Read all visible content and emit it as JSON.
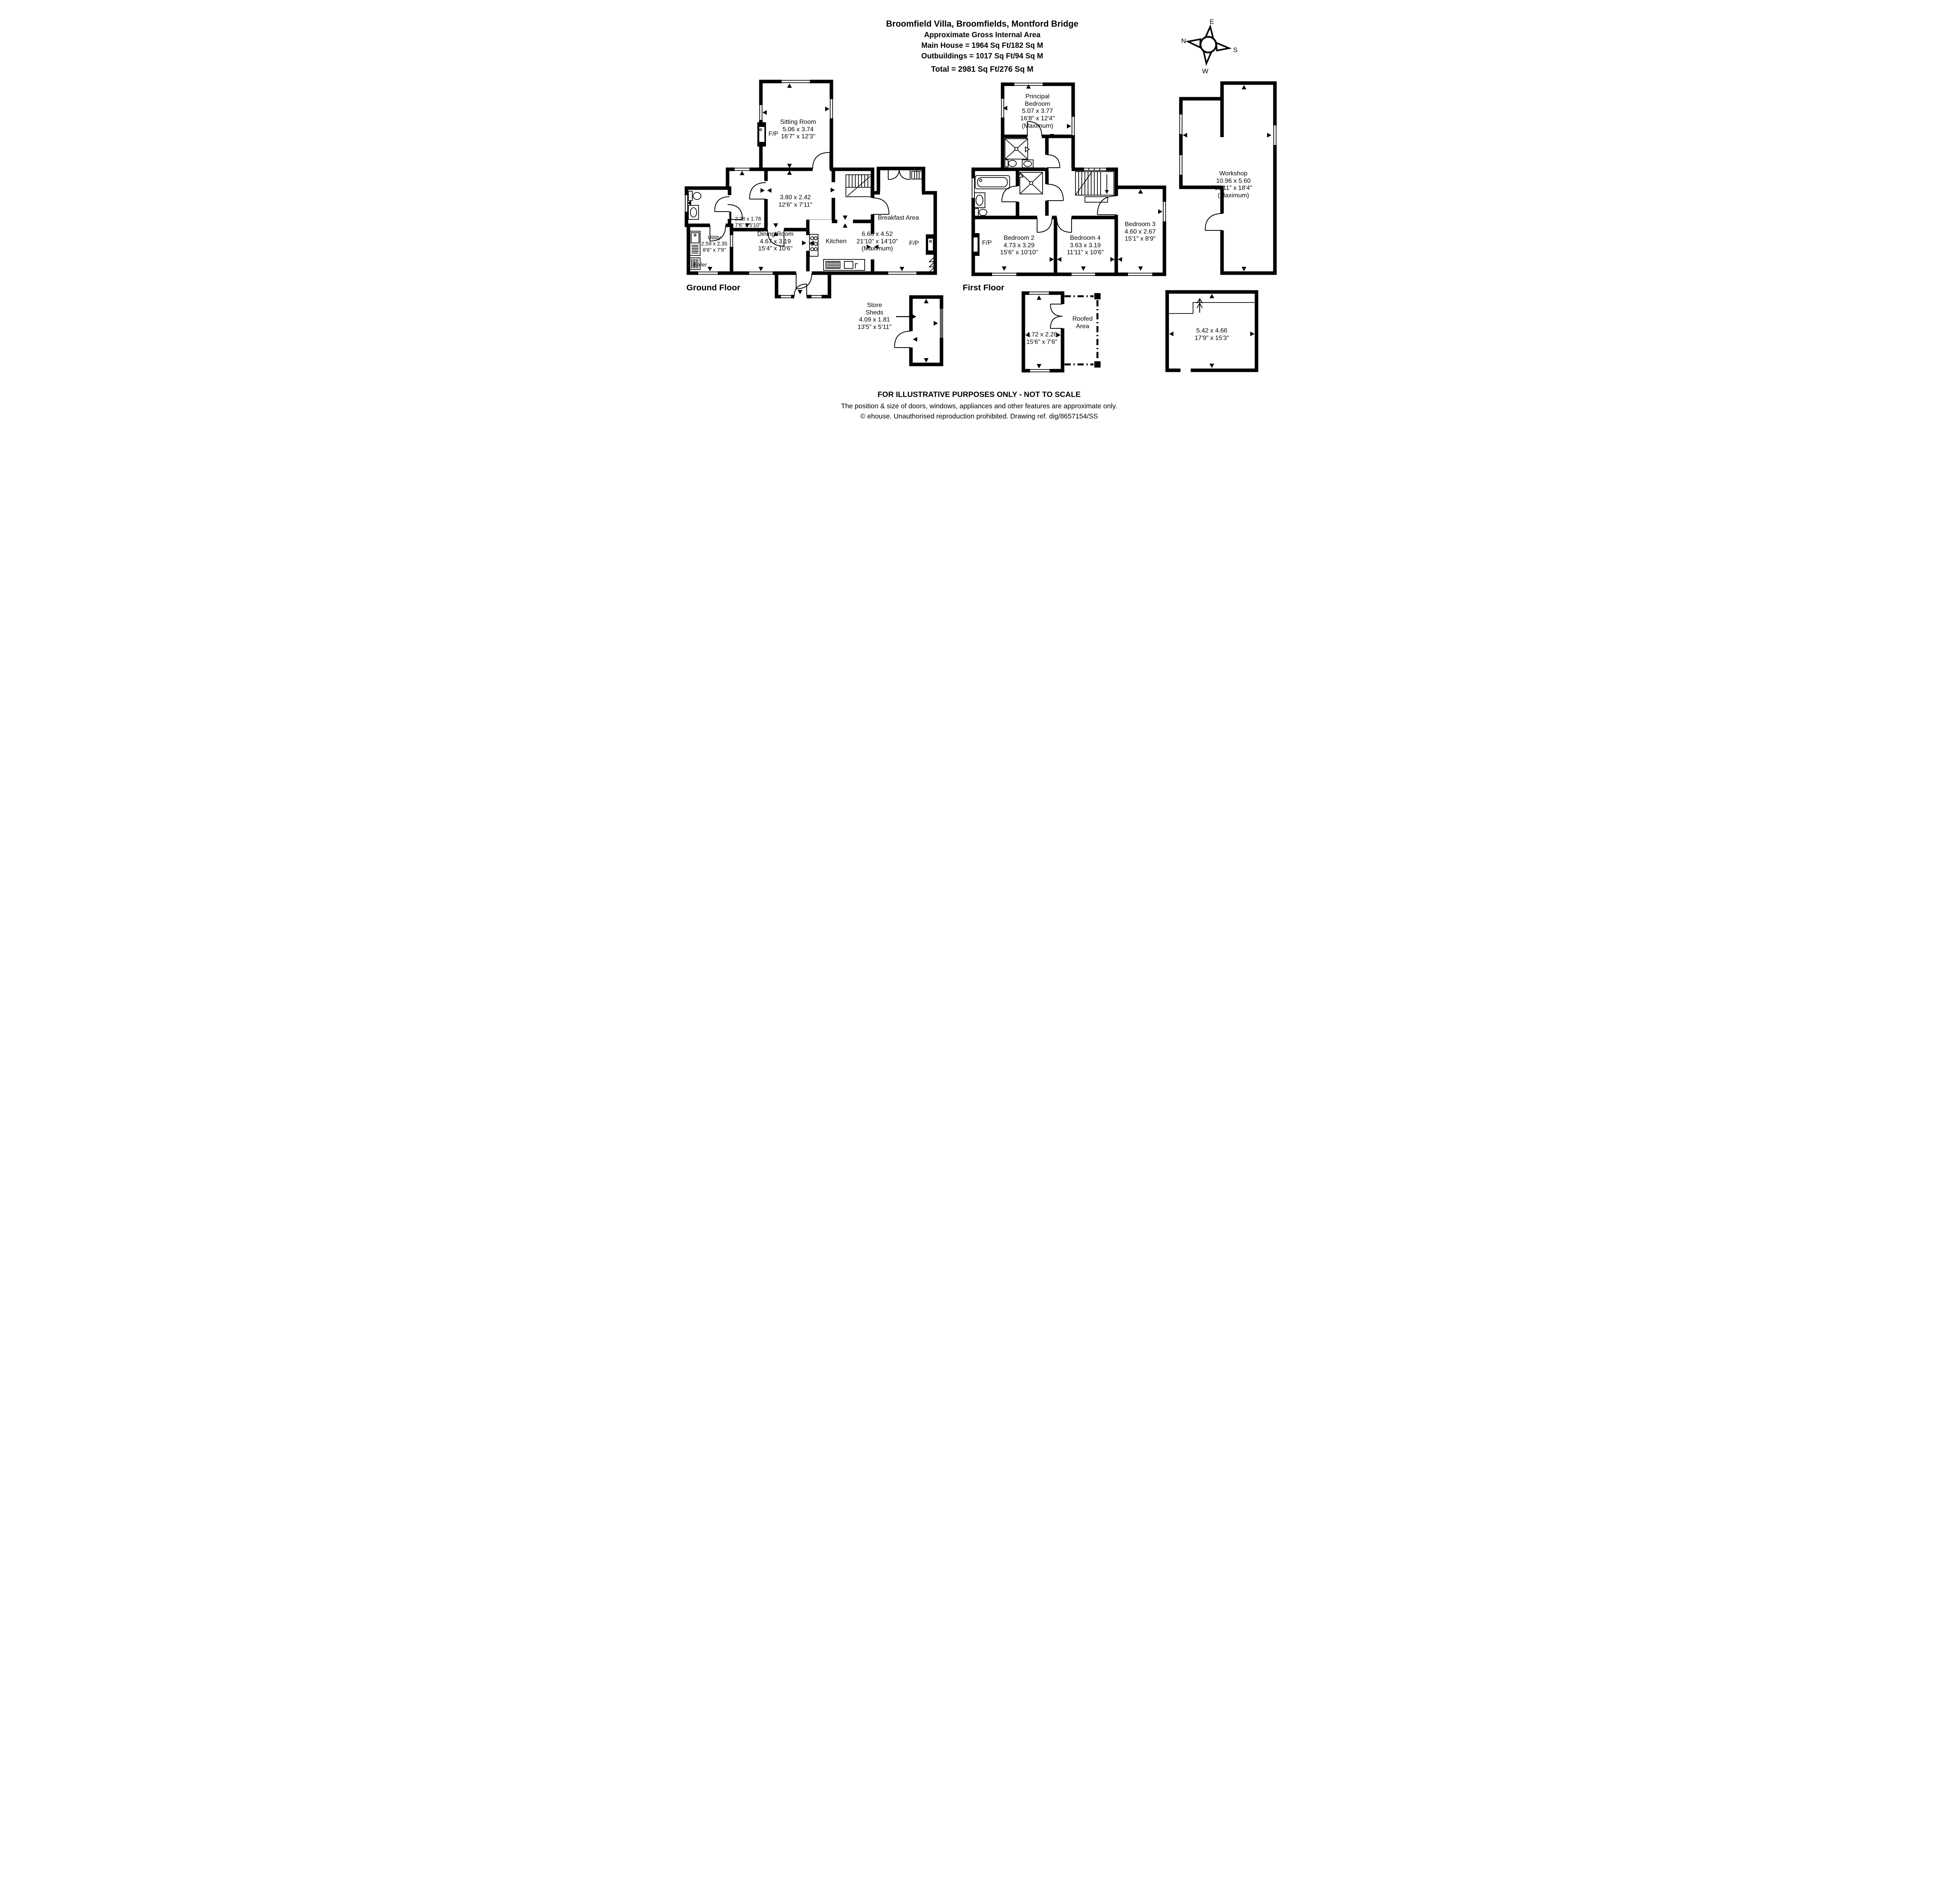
{
  "title": {
    "address": "Broomfield Villa, Broomfields, Montford Bridge",
    "subtitle": "Approximate Gross Internal Area",
    "main_house": "Main House = 1964 Sq Ft/182 Sq M",
    "outbuildings": "Outbuildings = 1017 Sq Ft/94 Sq M",
    "total": "Total = 2981 Sq Ft/276 Sq M"
  },
  "compass": {
    "north": "N",
    "east": "E",
    "south": "S",
    "west": "W"
  },
  "floors": {
    "ground_label": "Ground Floor",
    "first_label": "First Floor"
  },
  "fireplace_label": "F/P",
  "ground": {
    "sitting": {
      "name": "Sitting Room",
      "m": "5.06 x 3.74",
      "ft": "16'7\" x 12'3\""
    },
    "hall": {
      "m": "3.80 x 2.42",
      "ft": "12'6\" x 7'11\""
    },
    "lobby": {
      "m": "2.28 x 1.78",
      "ft": "7'6\" x 5'10\""
    },
    "utility": {
      "name": "Utility",
      "m": "2.59 x 2.35",
      "ft": "8'6\" x 7'9\""
    },
    "boiler": {
      "name": "Boiler"
    },
    "dining": {
      "name": "Dining Room",
      "m": "4.67 x 3.19",
      "ft": "15'4\" x 10'6\""
    },
    "kitchen": {
      "name": "Kitchen"
    },
    "breakfast": {
      "name": "Breakfast Area",
      "m": "6.66 x 4.52",
      "ft": "21'10\" x 14'10\"",
      "note": "(Maximum)"
    }
  },
  "first": {
    "principal": {
      "name": "Principal Bedroom",
      "m": "5.07 x 3.77",
      "ft": "16'8\" x 12'4\"",
      "note": "(Maximum)"
    },
    "bed2": {
      "name": "Bedroom 2",
      "m": "4.73 x 3.29",
      "ft": "15'6\" x 10'10\""
    },
    "bed4": {
      "name": "Bedroom 4",
      "m": "3.63 x 3.19",
      "ft": "11'11\" x 10'6\""
    },
    "bed3": {
      "name": "Bedroom 3",
      "m": "4.60 x 2.67",
      "ft": "15'1\" x 8'9\""
    }
  },
  "outbuildings": {
    "store": {
      "name": "Store Sheds",
      "m": "4.09 x 1.81",
      "ft": "13'5\" x 5'11\""
    },
    "shed": {
      "m": "4.72 x 2.28",
      "ft": "15'6\" x 7'6\""
    },
    "roofed": {
      "name": "Roofed Area"
    },
    "garage": {
      "m": "5.42 x 4.66",
      "ft": "17'9\" x 15'3\""
    },
    "workshop": {
      "name": "Workshop",
      "m": "10.96 x 5.60",
      "ft": "35'11\" x 18'4\"",
      "note": "(Maximum)"
    }
  },
  "footer": {
    "line1": "FOR ILLUSTRATIVE PURPOSES ONLY - NOT TO SCALE",
    "line2": "The position & size of doors, windows, appliances and other features are approximate only.",
    "line3": "© ehouse. Unauthorised reproduction prohibited. Drawing ref. dig/8657154/SS"
  }
}
